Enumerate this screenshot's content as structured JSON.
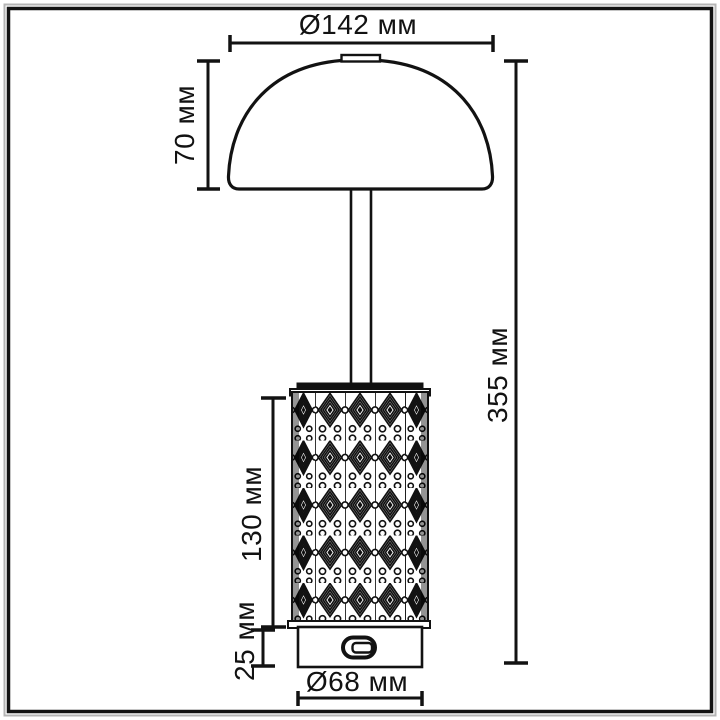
{
  "drawing": {
    "kind": "lamp-dimension-drawing",
    "unit": "мм"
  },
  "colors": {
    "line": "#121212",
    "frame_inner": "#141414",
    "frame_outer": "#b5b5b5",
    "background": "#ffffff",
    "pattern_ink": "#111111"
  },
  "dimensions": {
    "shade_diameter": {
      "label": "Ø142 мм",
      "value_mm": 142
    },
    "shade_height": {
      "label": "70 мм",
      "value_mm": 70
    },
    "total_height": {
      "label": "355 мм",
      "value_mm": 355
    },
    "body_height": {
      "label": "130 мм",
      "value_mm": 130
    },
    "base_height": {
      "label": "25 мм",
      "value_mm": 25
    },
    "base_diameter": {
      "label": "Ø68 мм",
      "value_mm": 68
    }
  }
}
